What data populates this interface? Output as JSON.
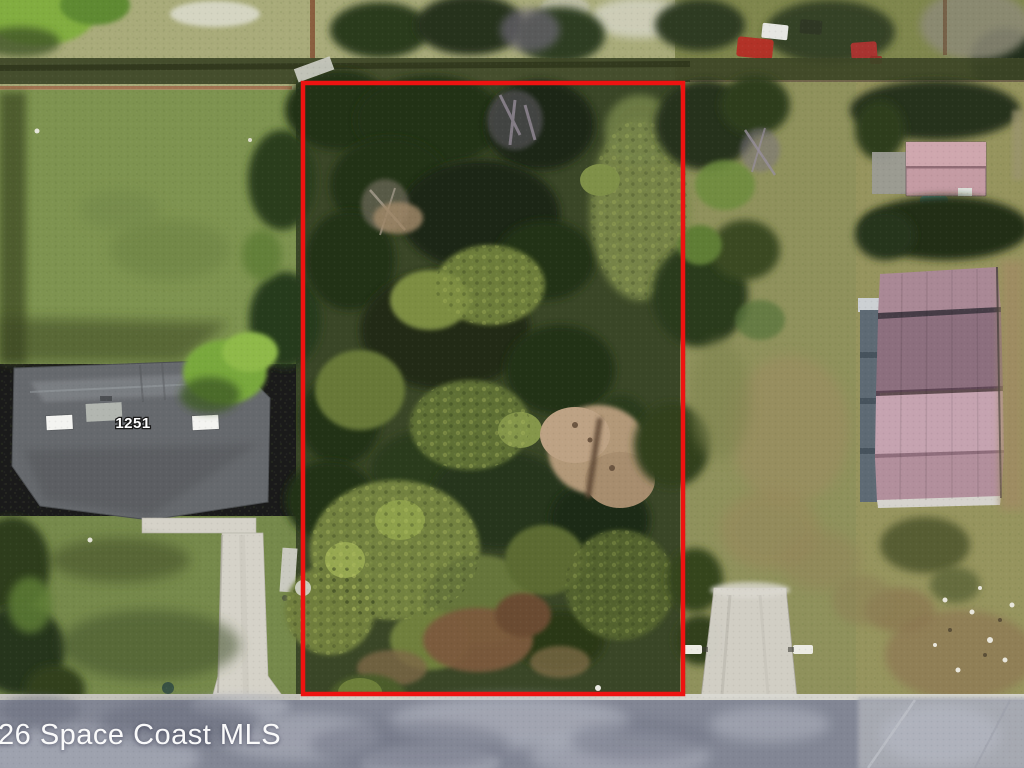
{
  "watermark": {
    "text": "26 Space Coast MLS"
  },
  "house": {
    "number": "1251"
  },
  "boundary": {
    "color": "#ee1311",
    "x": 303,
    "y": 83,
    "width": 380,
    "height": 611,
    "stroke_width": 4.5
  },
  "colors": {
    "boundary_red": "#ee1311",
    "dry_grass_top": "#a9ab7a",
    "lawn_green": "#7e9350",
    "lawn_green_lower": "#76894b",
    "lot_base_green": "#3a4627",
    "scrub_olive": "#8f915c",
    "right_yard_olive": "#96945e",
    "canopy_dark_green": "#243018",
    "canopy_light_green": "#73823f",
    "sand_clearing": "#b29878",
    "dirt_brown": "#7b5a3e",
    "house_roof_gray": "#66696d",
    "concrete_driveway": "#d7d4cb",
    "shed_roof_pink": "#c49ba3",
    "metal_roof_pink_top": "#a98895",
    "metal_roof_mauve": "#8c6f7e",
    "metal_roof_pink_light": "#c5a3b0",
    "metal_roof_pink_mid": "#b28f9c",
    "road_asphalt": "#828694",
    "road_light_patch": "#b6b9c4",
    "curb_concrete": "#d9d8d2",
    "watermark_white": "#ffffff"
  }
}
